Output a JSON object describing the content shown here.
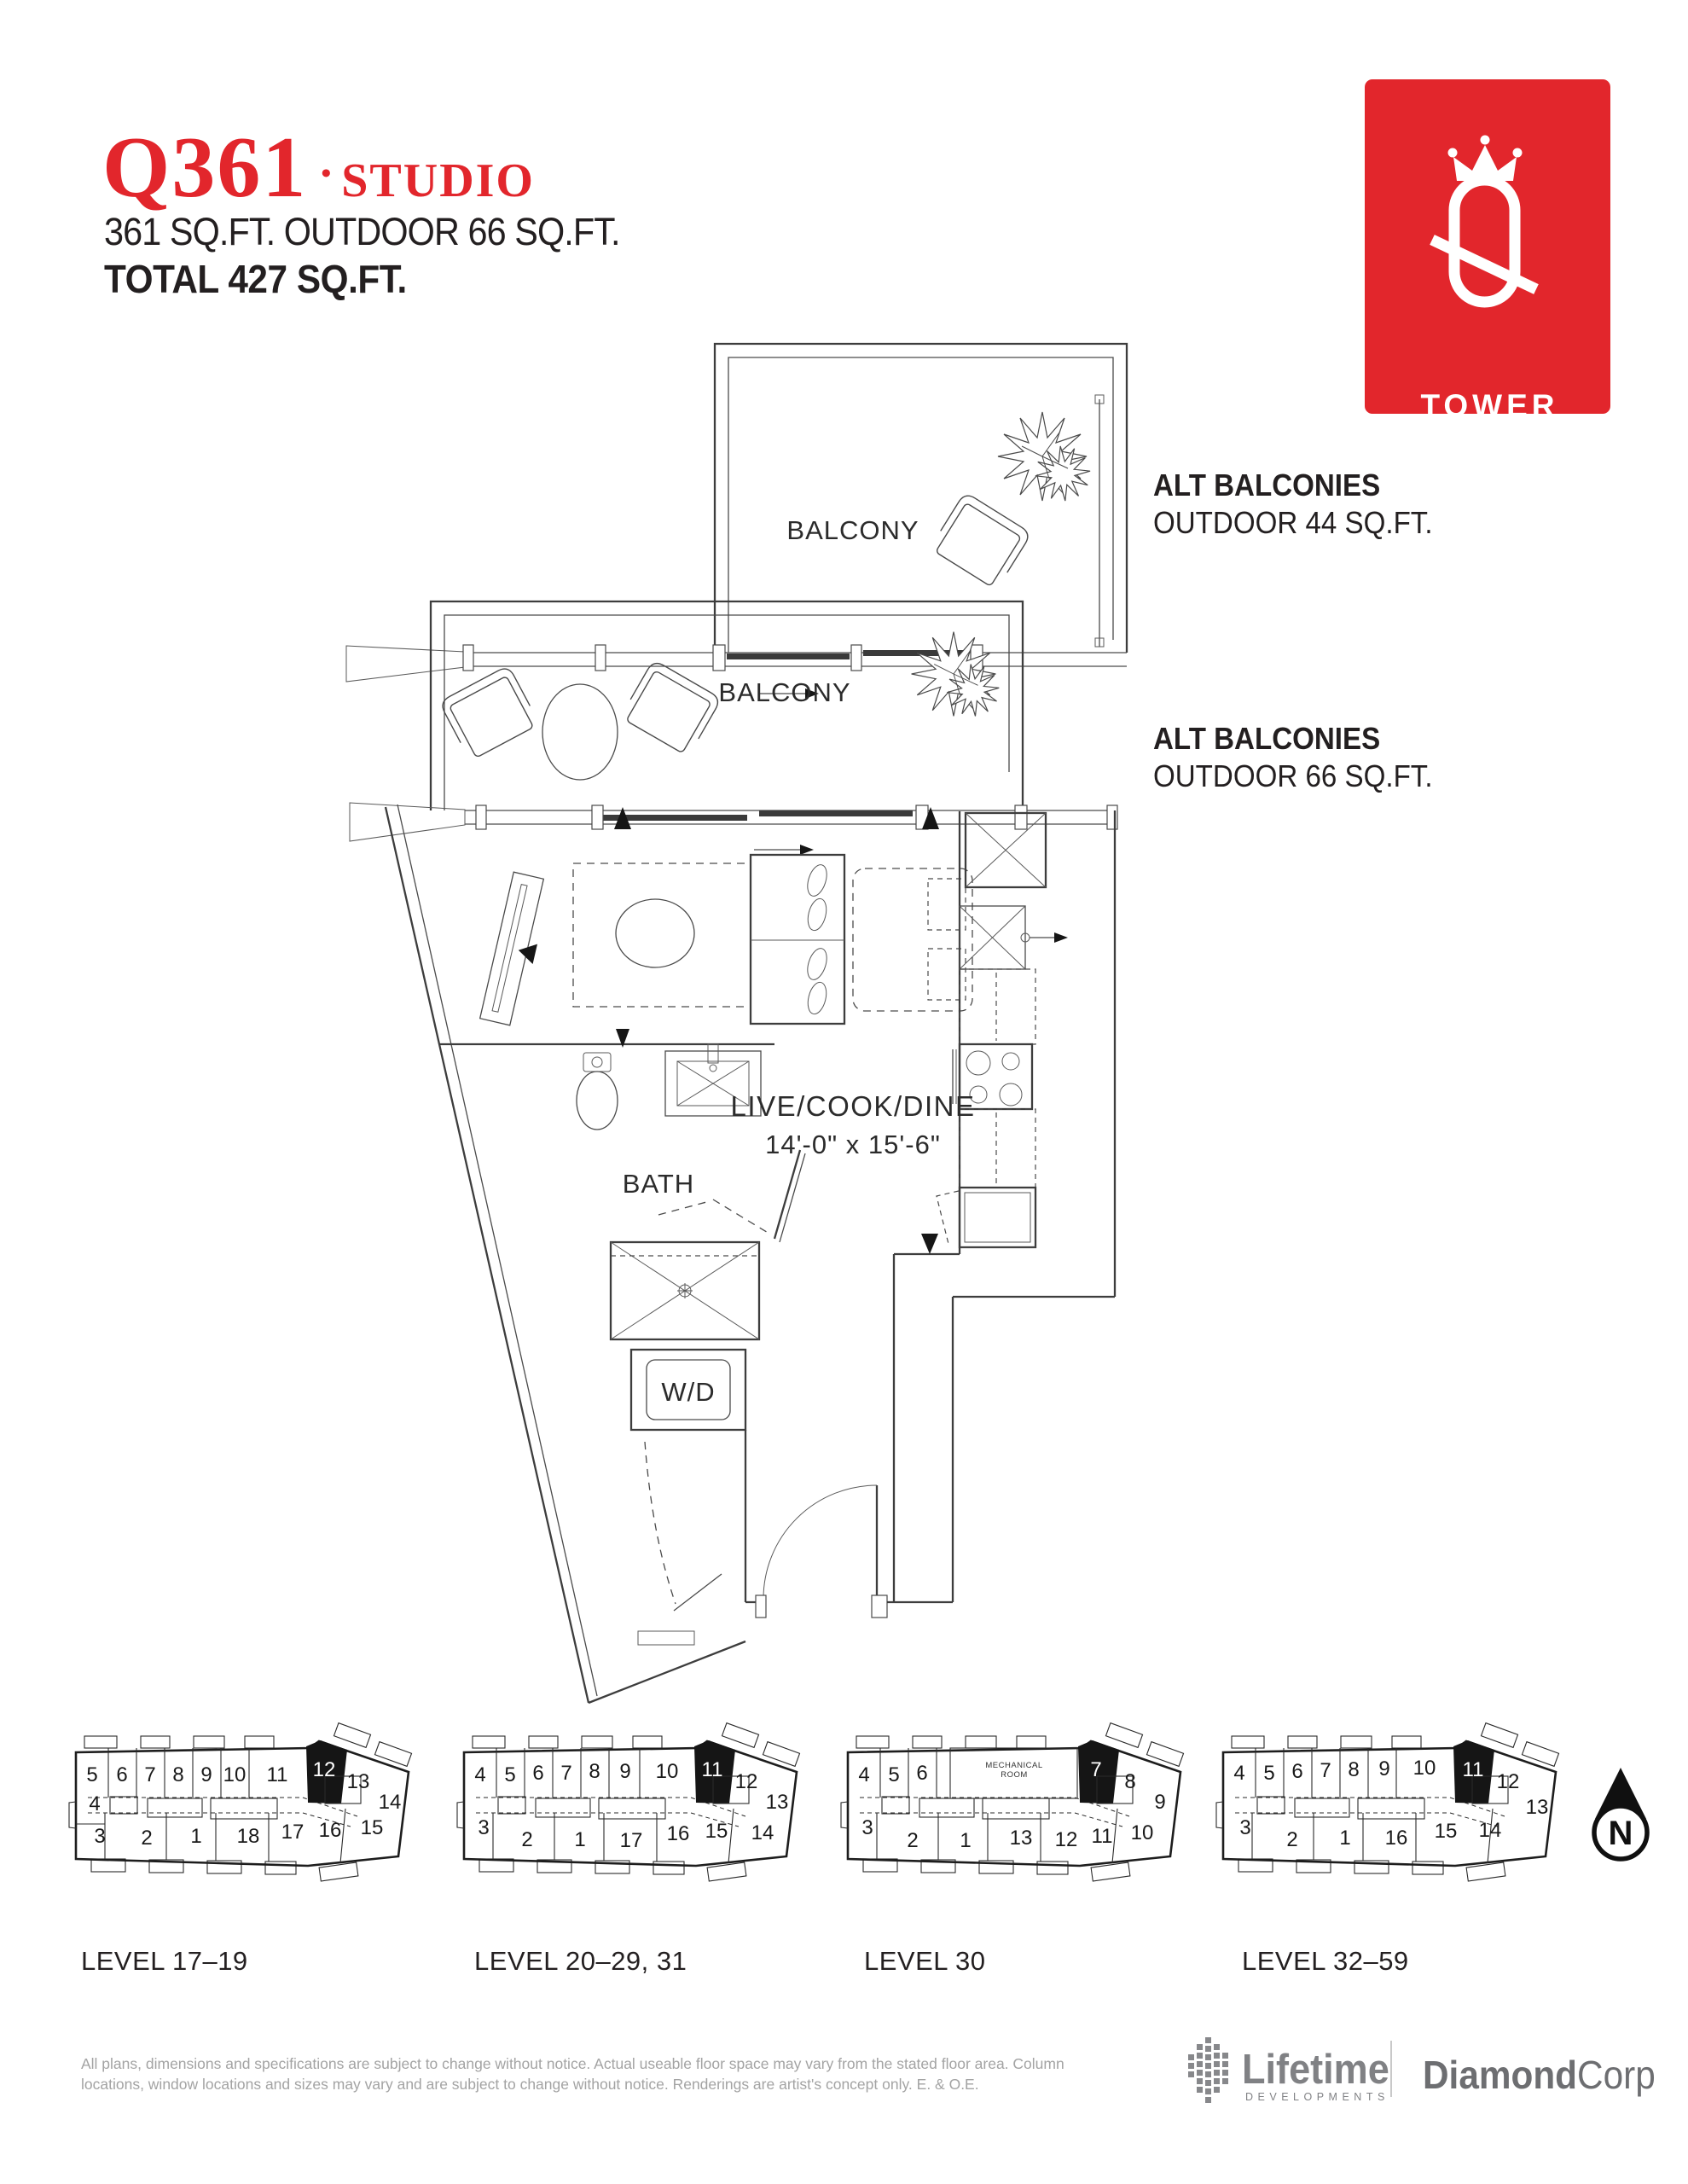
{
  "header": {
    "code": "Q361",
    "dot": "•",
    "type": "STUDIO",
    "area_line": "361 SQ.FT. OUTDOOR 66 SQ.FT.",
    "total_line": "TOTAL 427 SQ.FT."
  },
  "logo": {
    "tower": "TOWER"
  },
  "accent_color": "#e2262c",
  "alt_balconies": [
    {
      "title": "ALT BALCONIES",
      "subtitle": "OUTDOOR 44 SQ.FT."
    },
    {
      "title": "ALT BALCONIES",
      "subtitle": "OUTDOOR 66 SQ.FT."
    }
  ],
  "plan": {
    "balcony_top": "BALCONY",
    "balcony_main": "BALCONY",
    "room": "LIVE/COOK/DINE",
    "room_dims": "14'-0\" x 15'-6\"",
    "bath": "BATH",
    "laundry": "W/D"
  },
  "keyplans": [
    {
      "label": "LEVEL 17–19",
      "units": [
        "5",
        "6",
        "7",
        "8",
        "9",
        "10",
        "11",
        "12",
        "13",
        "14",
        "4",
        "3",
        "2",
        "1",
        "18",
        "17",
        "16",
        "15"
      ]
    },
    {
      "label": "LEVEL 20–29, 31",
      "units": [
        "4",
        "5",
        "6",
        "7",
        "8",
        "9",
        "10",
        "11",
        "12",
        "13",
        "3",
        "2",
        "1",
        "17",
        "16",
        "15",
        "14"
      ]
    },
    {
      "label": "LEVEL 30",
      "units": [
        "4",
        "5",
        "6",
        "7",
        "8",
        "9",
        "3",
        "2",
        "1",
        "13",
        "12",
        "11",
        "10"
      ],
      "mech": [
        "MECHANICAL",
        "ROOM"
      ]
    },
    {
      "label": "LEVEL 32–59",
      "units": [
        "4",
        "5",
        "6",
        "7",
        "8",
        "9",
        "10",
        "11",
        "12",
        "13",
        "3",
        "2",
        "1",
        "16",
        "15",
        "14"
      ]
    }
  ],
  "north_label": "N",
  "footer": {
    "disclaimer_1": "All plans, dimensions and specifications are subject to change without notice. Actual useable floor space may vary from the stated floor area. Column",
    "disclaimer_2": "locations, window locations and sizes may vary and are subject to change without notice. Renderings are artist's concept only. E. & O.E.",
    "lifetime_name": "Lifetime",
    "lifetime_sub": "DEVELOPMENTS",
    "diamond_bold": "Diamond",
    "diamond_light": "Corp"
  }
}
